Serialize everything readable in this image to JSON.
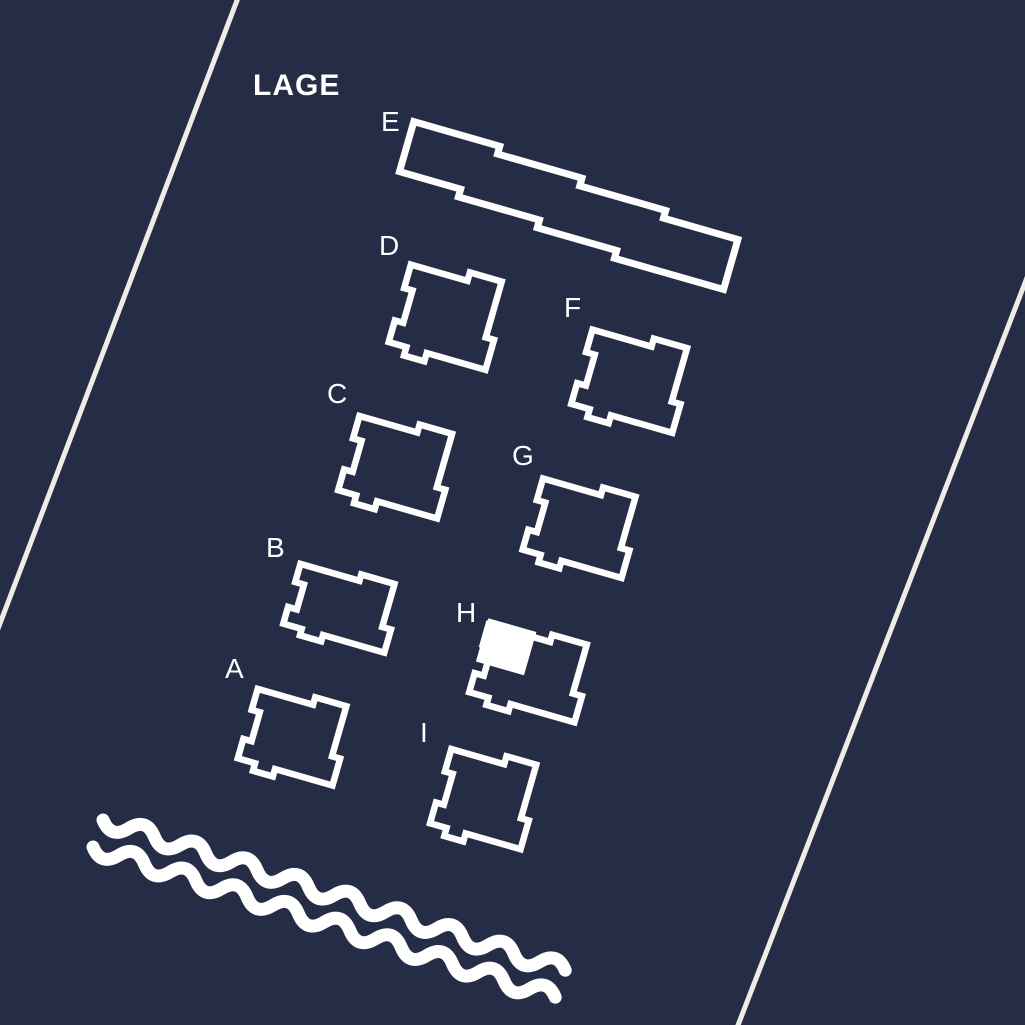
{
  "title": "LAGE",
  "colors": {
    "background": "#252C45",
    "building_outline": "#FFFFFF",
    "road": "#F0EBE7",
    "water": "#FFFFFF",
    "highlight": "#FFFFFF",
    "label": "#FFFFFF"
  },
  "map": {
    "buildings": [
      {
        "id": "A",
        "label": "A",
        "shape": "stepped-square",
        "label_pos": {
          "x": 225,
          "y": 655
        },
        "center": {
          "x": 291,
          "y": 736
        },
        "rotation": 16,
        "half_width": 45,
        "half_height": 43
      },
      {
        "id": "B",
        "label": "B",
        "shape": "stepped-square",
        "label_pos": {
          "x": 266,
          "y": 534
        },
        "center": {
          "x": 338,
          "y": 607
        },
        "rotation": 16,
        "half_width": 48,
        "half_height": 37
      },
      {
        "id": "C",
        "label": "C",
        "shape": "stepped-square",
        "label_pos": {
          "x": 327,
          "y": 380
        },
        "center": {
          "x": 394,
          "y": 466
        },
        "rotation": 16,
        "half_width": 47,
        "half_height": 46
      },
      {
        "id": "D",
        "label": "D",
        "shape": "stepped-square",
        "label_pos": {
          "x": 379,
          "y": 232
        },
        "center": {
          "x": 444,
          "y": 316
        },
        "rotation": 16,
        "half_width": 46,
        "half_height": 48
      },
      {
        "id": "E",
        "label": "E",
        "shape": "terraced-bar",
        "label_pos": {
          "x": 381,
          "y": 108
        },
        "center": {
          "x": 572,
          "y": 194
        },
        "rotation": 16,
        "half_width": 172,
        "half_height": 26
      },
      {
        "id": "F",
        "label": "F",
        "shape": "stepped-square",
        "label_pos": {
          "x": 564,
          "y": 294
        },
        "center": {
          "x": 628,
          "y": 380
        },
        "rotation": 16,
        "half_width": 48,
        "half_height": 46
      },
      {
        "id": "G",
        "label": "G",
        "shape": "stepped-square",
        "label_pos": {
          "x": 512,
          "y": 442
        },
        "center": {
          "x": 578,
          "y": 527
        },
        "rotation": 16,
        "half_width": 47,
        "half_height": 44
      },
      {
        "id": "H",
        "label": "H",
        "shape": "stepped-square",
        "label_pos": {
          "x": 456,
          "y": 599
        },
        "center": {
          "x": 527,
          "y": 672
        },
        "rotation": 16,
        "half_width": 50,
        "half_height": 42
      },
      {
        "id": "I",
        "label": "I",
        "shape": "stepped-square",
        "label_pos": {
          "x": 420,
          "y": 719
        },
        "center": {
          "x": 482,
          "y": 798
        },
        "rotation": 16,
        "half_width": 43,
        "half_height": 46
      }
    ],
    "highlighted_unit": {
      "building": "H",
      "rect": {
        "x": -52,
        "y": -41,
        "width": 50,
        "height": 45
      }
    },
    "roads": [
      {
        "name": "road-line-left",
        "x1": 241,
        "y1": -10,
        "x2": -12,
        "y2": 655
      },
      {
        "name": "road-line-right",
        "x1": 1035,
        "y1": 257,
        "x2": 735,
        "y2": 1033
      }
    ],
    "waves": [
      {
        "name": "wave-line-1",
        "x": 103,
        "y": 820,
        "angle": 18,
        "half_waves": 18
      },
      {
        "name": "wave-line-2",
        "x": 93,
        "y": 847,
        "angle": 18,
        "half_waves": 18
      }
    ]
  }
}
